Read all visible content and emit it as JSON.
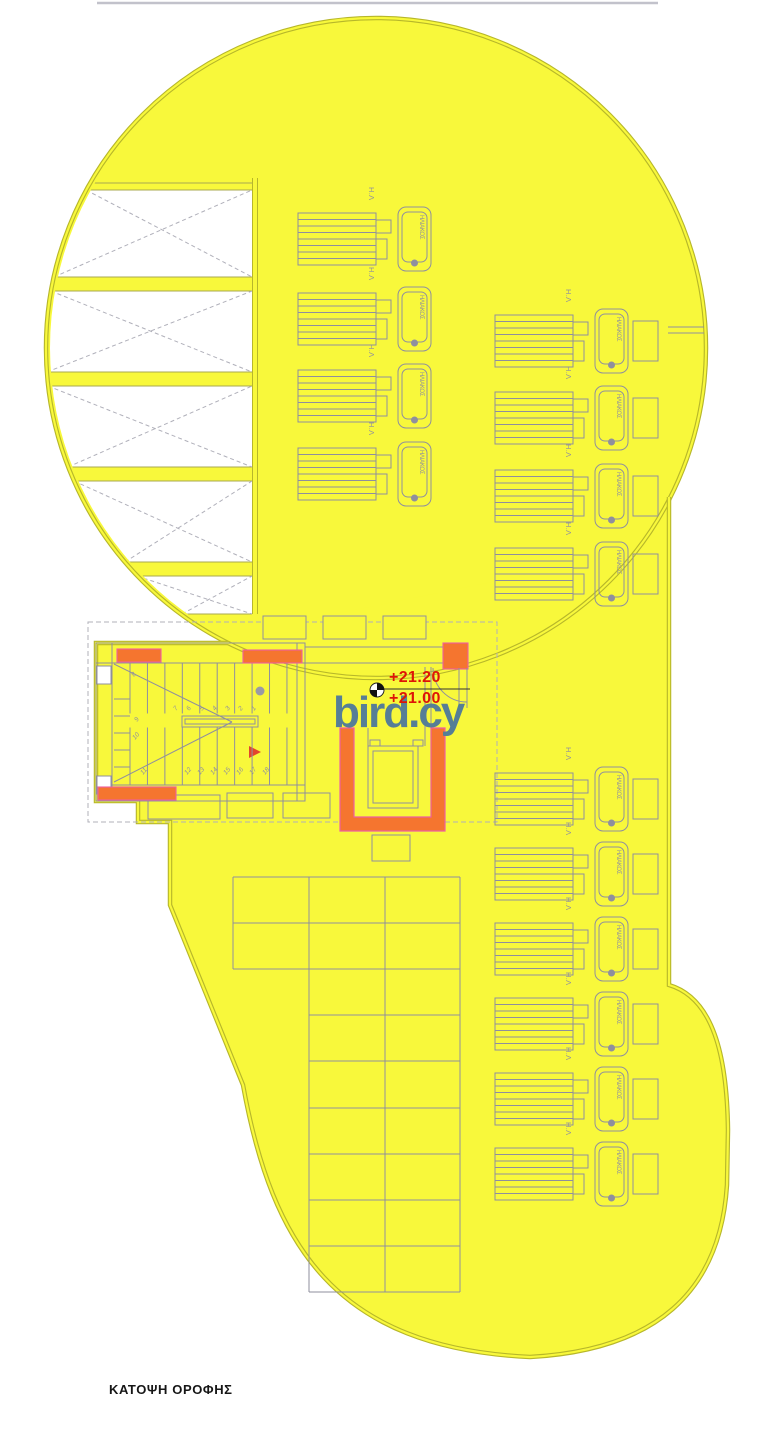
{
  "plan": {
    "title": "ΚΑΤΟΨΗ ΟΡΟΦΗΣ",
    "watermark": "bird.cy",
    "levels": {
      "upper": "+21.20",
      "lower": "+21.00"
    },
    "stair": {
      "upper_flight": [
        "7",
        "6",
        "5",
        "4",
        "3",
        "2",
        "1"
      ],
      "corner": "8",
      "side": [
        "9",
        "10",
        "11"
      ],
      "lower_flight": [
        "12",
        "13",
        "14",
        "15",
        "16",
        "17",
        "18"
      ]
    },
    "solar": {
      "unit_label": "Η.Λ",
      "tank_text": "ΗΛΙΑΚΟΣ",
      "columns": [
        {
          "id": "top-center",
          "units": 4
        },
        {
          "id": "upper-right",
          "units": 4
        },
        {
          "id": "lower-right",
          "units": 6
        }
      ]
    },
    "colors": {
      "roof_yellow": "#F8F83B",
      "outline_olive": "#B7B72A",
      "line_gray": "#8F8F9E",
      "hatch_gray": "#B0B0BA",
      "wall_orange": "#F5752F",
      "wall_magenta": "#EE5FA0",
      "level_red": "#DE1507",
      "watermark_steel": "#567E96",
      "title_ink": "#161616"
    }
  }
}
